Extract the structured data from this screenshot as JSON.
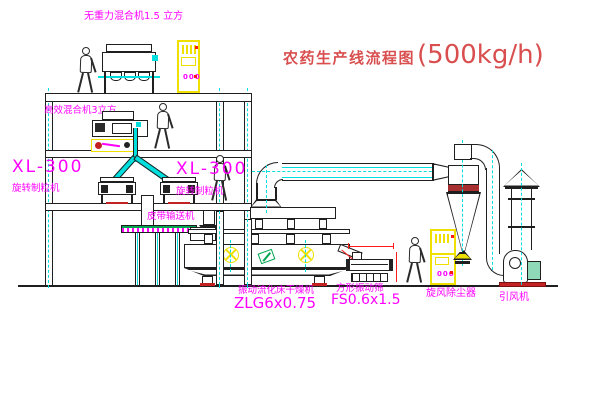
{
  "title": {
    "text": "农药生产线流程图",
    "capacity": "(500kg/h)"
  },
  "labels": {
    "top_mixer": "无重力混合机1.5 立方",
    "second_mixer": "高效混合机3立方",
    "granulator_left": {
      "model": "XL-300",
      "name": "旋转制粒机"
    },
    "granulator_mid": {
      "model": "XL-300",
      "name": "旋转制粒机"
    },
    "belt_conveyor": "皮带输送机",
    "dryer": {
      "name": "振动流化床干燥机",
      "model": "ZLG6x0.75"
    },
    "screen": {
      "name": "方形振动筛",
      "model": "FS0.6x1.5"
    },
    "cyclone": "旋风除尘器",
    "fan": "引风机"
  },
  "cabinet": {
    "display": "000"
  },
  "colors": {
    "line": "#1f1f1f",
    "magenta": "#ff00ff",
    "cyan": "#00dede",
    "yellow": "#f0e000",
    "red": "#ff1a1a",
    "title-red": "#d94f4f",
    "green": "#00a550",
    "dark-red": "#a83030"
  }
}
